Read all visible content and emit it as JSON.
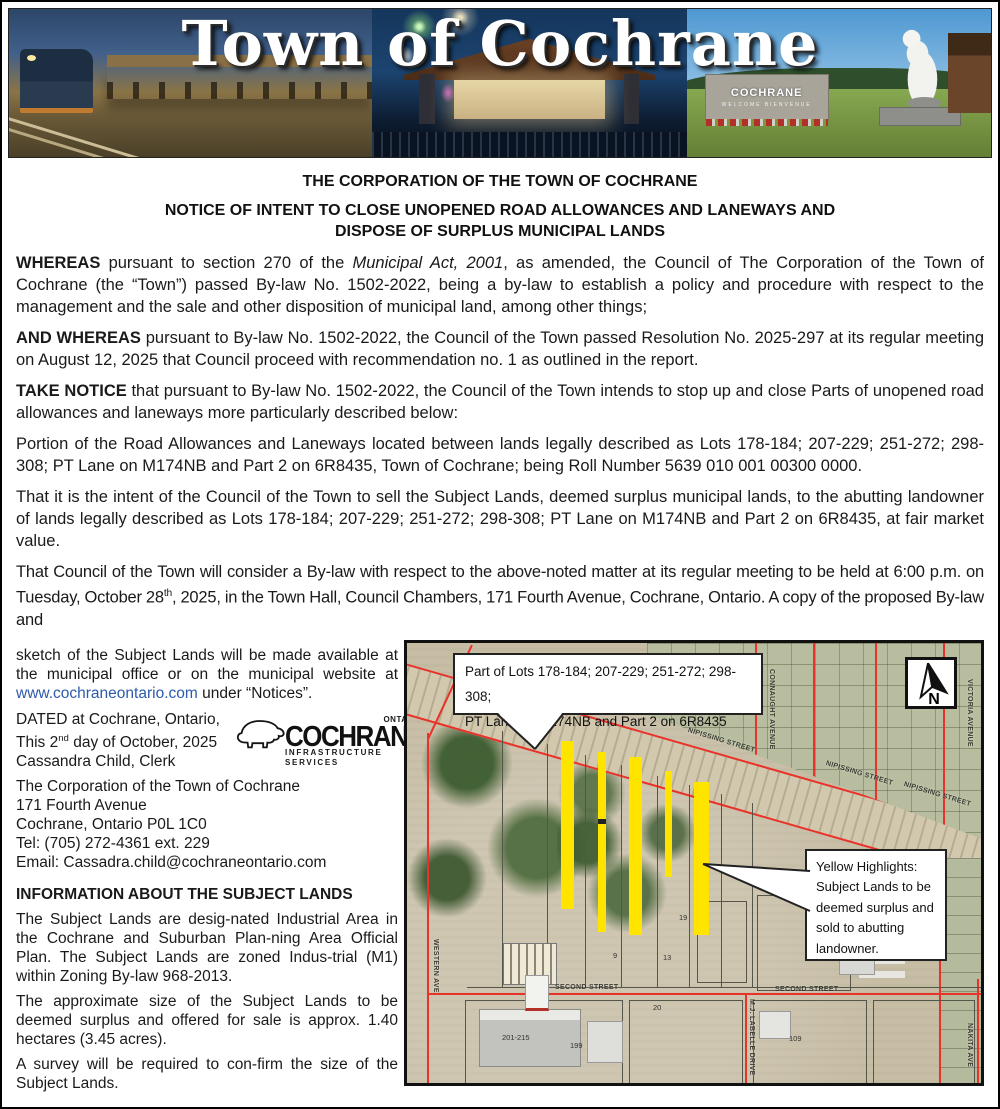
{
  "banner": {
    "title": "Town of Cochrane",
    "sign_text": "COCHRANE",
    "sign_sub": "WELCOME BIENVENUE"
  },
  "header": {
    "line1": "THE CORPORATION OF THE TOWN OF COCHRANE",
    "line2": "NOTICE OF INTENT TO CLOSE UNOPENED ROAD ALLOWANCES AND LANEWAYS AND",
    "line3": "DISPOSE OF SURPLUS MUNICIPAL LANDS"
  },
  "body": {
    "whereas_label": "WHEREAS",
    "whereas_pre": " pursuant to section 270 of the ",
    "whereas_italic": "Municipal Act, 2001",
    "whereas_post": ", as amended, the Council of The Corporation of the Town of Cochrane (the “Town”) passed By-law No. 1502-2022, being a by-law to establish a policy and procedure with respect to the management and the sale and other disposition of municipal land, among other things;",
    "and_whereas_label": "AND WHEREAS",
    "and_whereas_text": " pursuant to By-law No. 1502-2022, the Council of the Town passed Resolution No. 2025-297 at its regular meeting on August 12, 2025 that Council proceed with recommendation no. 1 as outlined in the report.",
    "take_notice_label": "TAKE NOTICE",
    "take_notice_text": " that pursuant to By-law No. 1502-2022, the Council of the Town intends to stop up and close Parts of unopened road allowances and laneways more particularly described below:",
    "portion_text": "Portion of the Road Allowances and Laneways located between lands legally described as Lots 178-184; 207-229; 251-272; 298-308; PT Lane on M174NB and Part 2 on 6R8435, Town of Cochrane; being Roll Number 5639 010 001 00300 0000.",
    "intent_text": "That it is the intent of the Council of the Town to sell the Subject Lands, deemed surplus municipal lands, to the abutting landowner of lands legally described as Lots 178-184; 207-229; 251-272; 298-308; PT Lane on M174NB and Part 2 on 6R8435, at fair market value.",
    "council_pre": "That Council of the Town will consider a By-law with respect to the above-noted matter at its regular meeting to be held at 6:00 p.m. on Tuesday, October 28",
    "council_sup": "th",
    "council_post": ", 2025, in the Town Hall, Council Chambers, 171 Fourth Avenue, Cochrane, Ontario. A copy of the proposed By-law and"
  },
  "left": {
    "wrap_pre": "sketch of the Subject Lands will be made available at the municipal office or on the municipal website at ",
    "link": "www.cochraneontario.com",
    "wrap_post": " under “Notices”.",
    "dated": {
      "l1": "DATED at Cochrane, Ontario,",
      "l2_pre": "This 2",
      "l2_sup": "nd",
      "l2_post": " day of October, 2025",
      "l3": "Cassandra Child, Clerk"
    },
    "logo": {
      "region": "ONTARIO",
      "name": "COCHRANE",
      "tagline": "INFRASTRUCTURE SERVICES"
    },
    "address": [
      "The Corporation of the Town of Cochrane",
      "171 Fourth Avenue",
      "Cochrane, Ontario P0L 1C0",
      "Tel: (705) 272-4361 ext. 229",
      "Email: Cassadra.child@cochraneontario.com"
    ],
    "info": {
      "heading": "INFORMATION ABOUT THE SUBJECT LANDS",
      "p1": "The Subject Lands are desig-nated Industrial Area in the Cochrane and Suburban Plan-ning Area Official Plan. The Subject Lands are zoned Indus-trial (M1) within Zoning By-law 968-2013.",
      "p2": "The approximate size of the Subject Lands to be deemed surplus and offered for sale is approx. 1.40 hectares (3.45 acres).",
      "p3": "A survey will be required to con-firm the size of the Subject Lands."
    }
  },
  "map": {
    "callout_top_line1": "Part of Lots 178-184; 207-229; 251-272; 298-308;",
    "callout_top_line2": "PT Lane on M174NB and Part 2 on 6R8435",
    "callout_right_lines": [
      "Yellow Highlights:",
      "Subject Lands to be",
      "deemed surplus and",
      "sold to abutting",
      "landowner."
    ],
    "north_label": "N",
    "streets": [
      "NIPISSING STREET",
      "NIPISSING STREET",
      "NIPISSING STREET",
      "CONNAUGHT AVENUE",
      "VICTORIA AVENUE",
      "WESTERN AVE",
      "SECOND STREET",
      "SECOND STREET",
      "M.J. LABELLE DRIVE",
      "NAKITA AVE"
    ],
    "parcels": [
      "201-215",
      "199",
      "109",
      "20",
      "19",
      "13",
      "9"
    ],
    "highlight_color": "#ffe400",
    "road_color": "#e8322a"
  },
  "colors": {
    "link": "#2e5aac",
    "map_border": "#111111",
    "text": "#1a1a1a"
  }
}
